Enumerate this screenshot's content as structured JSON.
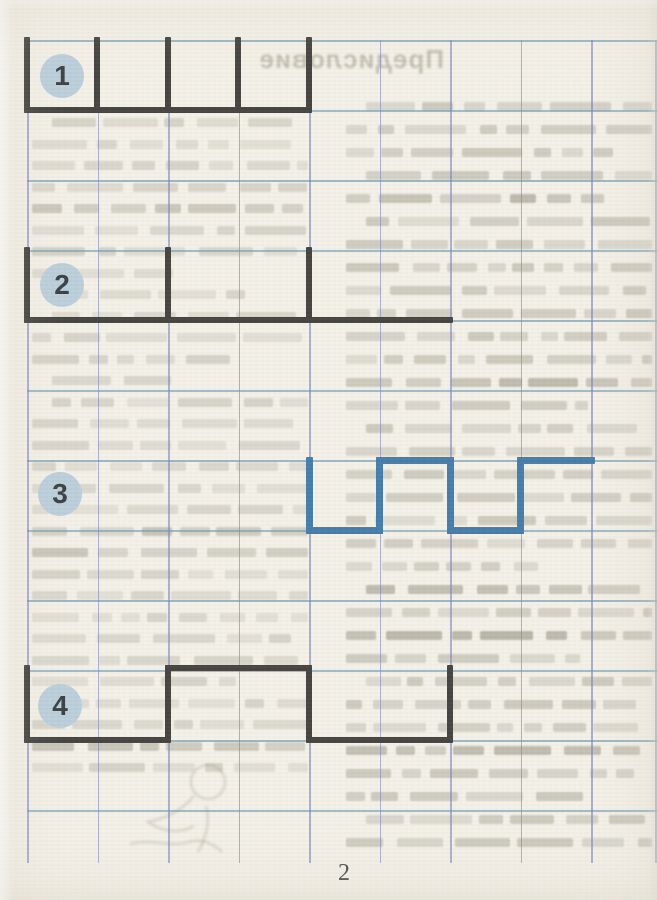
{
  "page": {
    "page_number": "2",
    "paper_color": "#f3f0e7"
  },
  "grid": {
    "vertical_color": "rgba(118,124,188,0.6)",
    "horizontal_color": "rgba(92,144,176,0.6)",
    "verticals_x": [
      27,
      97.5,
      168,
      238.5,
      309,
      379.5,
      450,
      520.5,
      591,
      655
    ],
    "horizontals_y": [
      40,
      110,
      180,
      250,
      320,
      390,
      460,
      530,
      600,
      670,
      740,
      810
    ],
    "v_top": 40,
    "v_bottom": 863,
    "h_left": 27,
    "h_right": 657
  },
  "badge": {
    "fill": "#b8cdda",
    "text_color": "#30373c",
    "diameter": 44
  },
  "exercises": [
    {
      "number": "1",
      "badge_cx": 62,
      "badge_cy": 76,
      "color": "#3b3a37",
      "segments": [
        [
          24,
          37,
          6,
          76
        ],
        [
          94,
          37,
          6,
          76
        ],
        [
          165,
          37,
          6,
          76
        ],
        [
          235,
          37,
          6,
          76
        ],
        [
          306,
          37,
          6,
          76
        ],
        [
          24,
          107,
          288,
          6
        ]
      ]
    },
    {
      "number": "2",
      "badge_cx": 62,
      "badge_cy": 285,
      "color": "#3b3a37",
      "segments": [
        [
          24,
          247,
          6,
          76
        ],
        [
          165,
          247,
          6,
          76
        ],
        [
          306,
          247,
          6,
          76
        ],
        [
          24,
          317,
          429,
          6
        ]
      ]
    },
    {
      "number": "3",
      "badge_cx": 60,
      "badge_cy": 494,
      "color": "#3a76a8",
      "segments": [
        [
          306,
          457,
          7,
          77
        ],
        [
          306,
          527,
          77,
          7
        ],
        [
          376,
          457,
          7,
          77
        ],
        [
          376,
          457,
          78,
          7
        ],
        [
          447,
          457,
          7,
          77
        ],
        [
          447,
          527,
          77,
          7
        ],
        [
          517,
          457,
          7,
          77
        ],
        [
          517,
          457,
          78,
          7
        ]
      ]
    },
    {
      "number": "4",
      "badge_cx": 60,
      "badge_cy": 706,
      "color": "#3b3a37",
      "segments": [
        [
          24,
          665,
          6,
          78
        ],
        [
          24,
          737,
          147,
          6
        ],
        [
          165,
          665,
          6,
          78
        ],
        [
          165,
          665,
          147,
          6
        ],
        [
          306,
          665,
          6,
          78
        ],
        [
          306,
          737,
          147,
          6
        ],
        [
          447,
          665,
          6,
          78
        ]
      ]
    }
  ],
  "ghost": {
    "heading": "Предисловие",
    "heading_pos": {
      "left": 212,
      "top": 44,
      "width": 232,
      "font_size": 26
    },
    "ink": "125,122,104",
    "columns": [
      {
        "x": 32,
        "width": 276,
        "top": 118,
        "step": 21.5,
        "count": 31,
        "alpha": 0.2,
        "seed": 7
      },
      {
        "x": 346,
        "width": 306,
        "top": 102,
        "step": 23,
        "count": 33,
        "alpha": 0.27,
        "seed": 13
      }
    ]
  }
}
